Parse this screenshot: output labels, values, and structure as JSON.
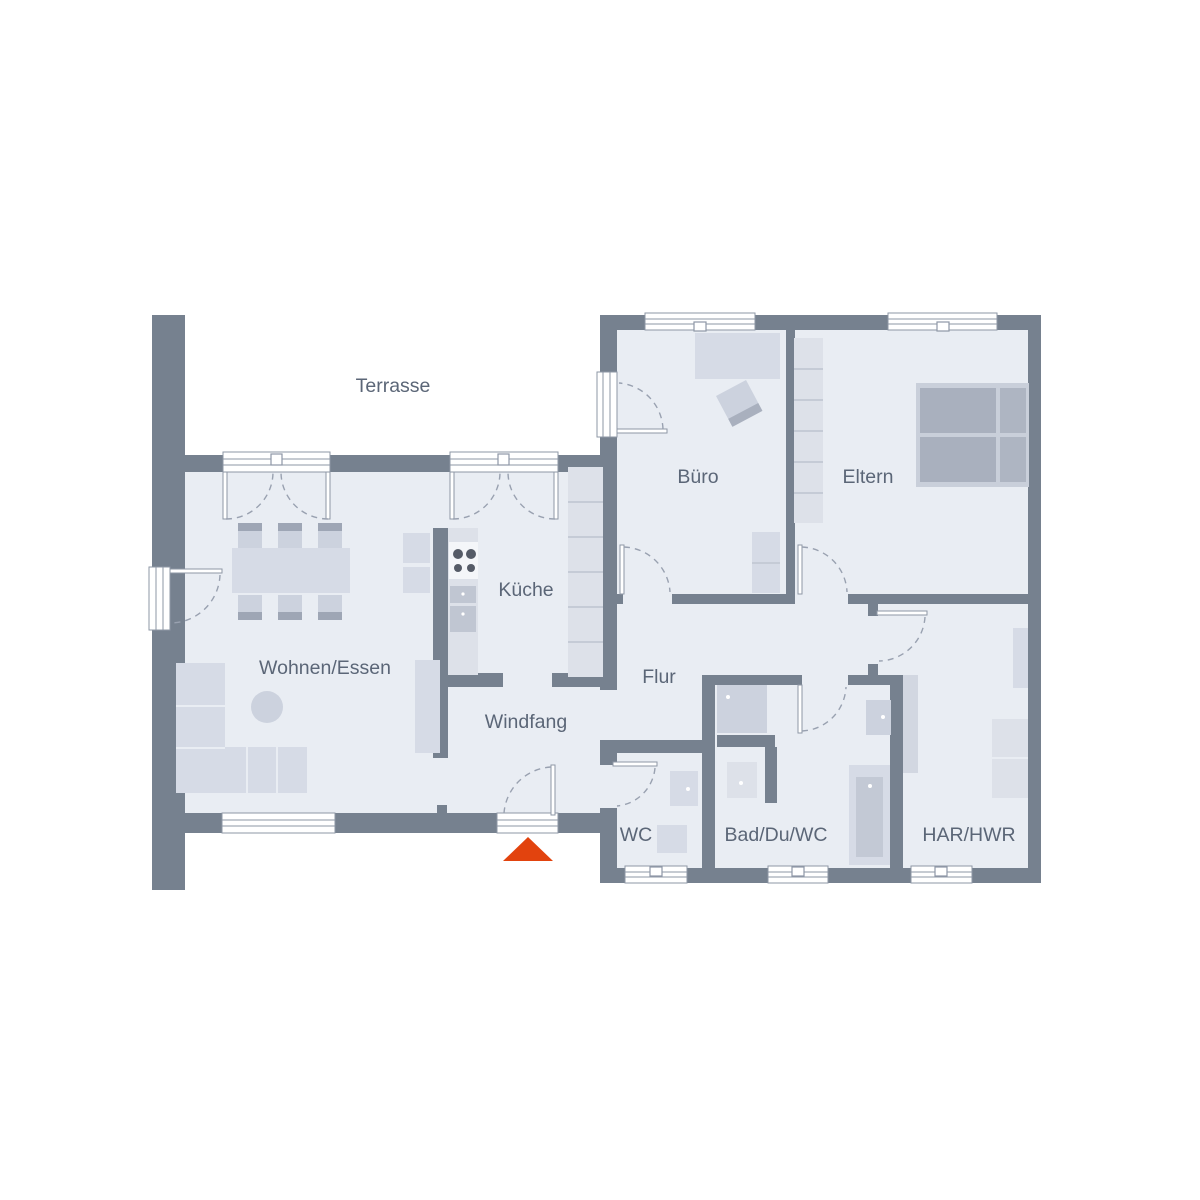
{
  "plan": {
    "rooms": [
      {
        "id": "terrasse",
        "label": "Terrasse"
      },
      {
        "id": "wohnen_essen",
        "label": "Wohnen/Essen"
      },
      {
        "id": "kueche",
        "label": "Küche"
      },
      {
        "id": "windfang",
        "label": "Windfang"
      },
      {
        "id": "flur",
        "label": "Flur"
      },
      {
        "id": "buero",
        "label": "Büro"
      },
      {
        "id": "eltern",
        "label": "Eltern"
      },
      {
        "id": "wc",
        "label": "WC"
      },
      {
        "id": "bad",
        "label": "Bad/Du/WC"
      },
      {
        "id": "har",
        "label": "HAR/HWR"
      }
    ],
    "entrance_marker": {
      "symbol": "triangle",
      "color": "#e2430e"
    },
    "palette": {
      "wall": "#76818f",
      "floor": "#e9edf3",
      "furniture_light": "#d6dbe6",
      "furniture_dark": "#a9b0be",
      "label_text": "#5b6677",
      "background": "#ffffff"
    }
  }
}
